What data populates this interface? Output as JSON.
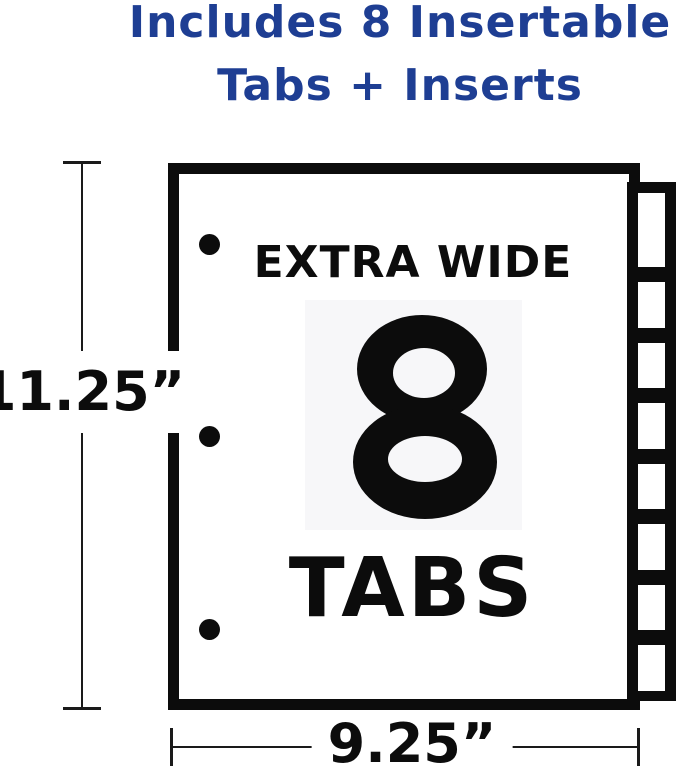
{
  "heading": {
    "line1": "Includes 8 Insertable",
    "line2": "Tabs + Inserts"
  },
  "sheet": {
    "top_label": "EXTRA WIDE",
    "big_number": "8",
    "bottom_label": "TABS",
    "tab_count": 8,
    "hole_punch_count": 3
  },
  "dimensions": {
    "height_label": "11.25”",
    "width_label": "9.25”"
  },
  "colors": {
    "heading_blue": "#1e3e93",
    "ink": "#0c0c0c",
    "number_panel_bg": "#f7f7f9",
    "paper": "#ffffff"
  }
}
